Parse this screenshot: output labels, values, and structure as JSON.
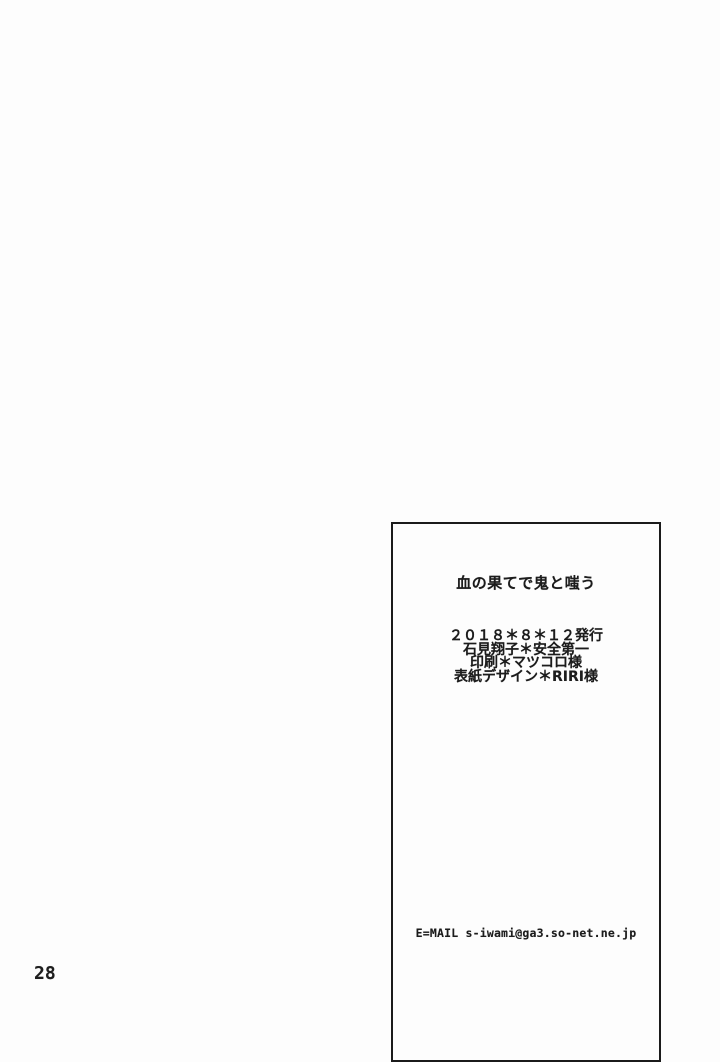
{
  "page": {
    "page_number": "28"
  },
  "colophon": {
    "title": "血の果てで鬼と嗤う",
    "credits": [
      "２０１８＊８＊１２発行",
      "石見翔子＊安全第一",
      "印刷＊マツコロ様",
      "表紙デザイン＊RIRI様"
    ],
    "email": "E=MAIL s-iwami@ga3.so-net.ne.jp"
  },
  "colors": {
    "background": "#fdfdfd",
    "text": "#1c1c1c",
    "box_border": "#1b1b1b"
  }
}
